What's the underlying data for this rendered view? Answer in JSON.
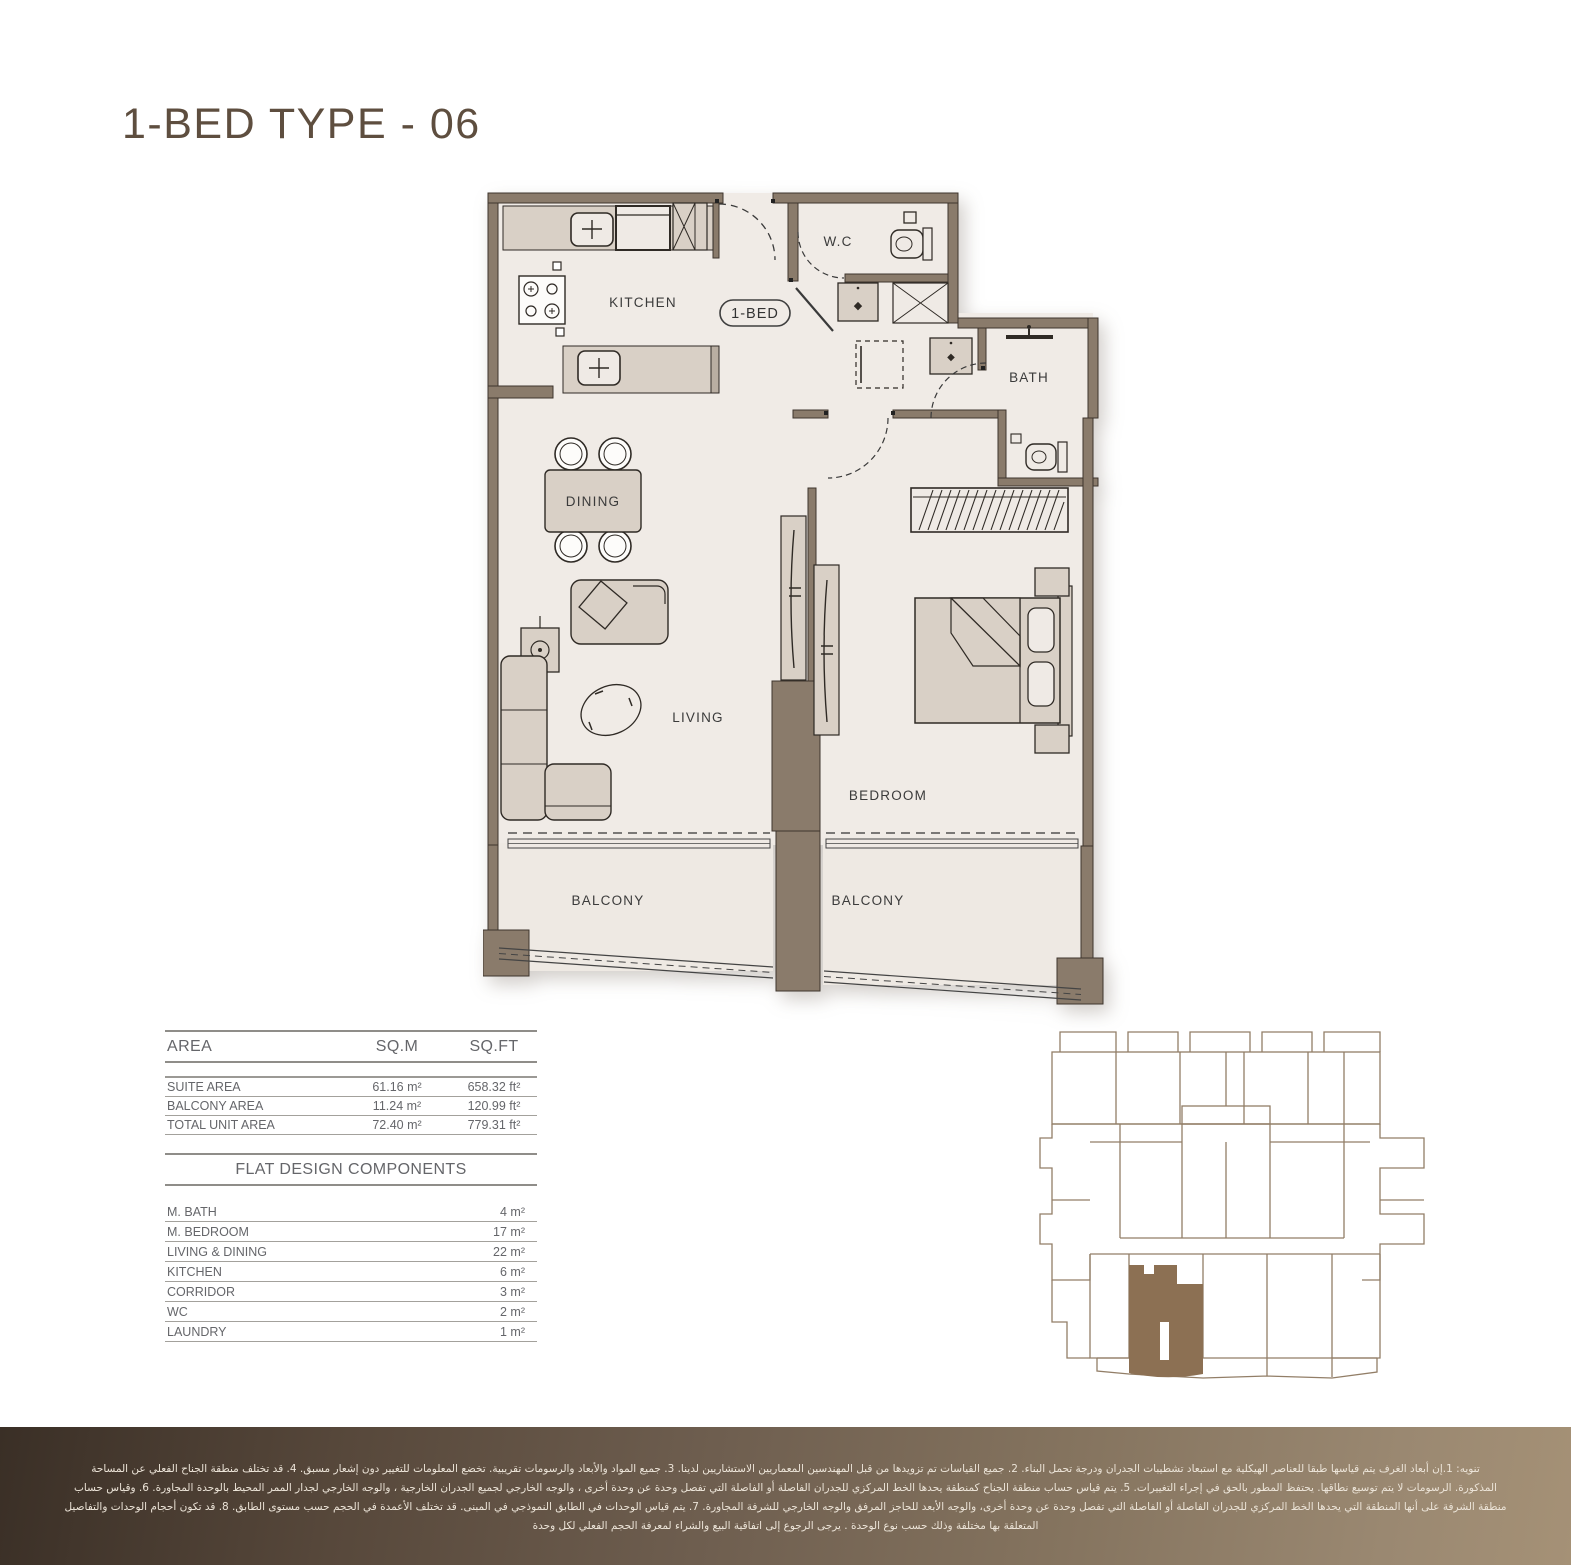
{
  "page": {
    "title": "1-BED TYPE - 06"
  },
  "plan": {
    "badge": "1-BED",
    "labels": {
      "kitchen": "KITCHEN",
      "wc": "W.C",
      "bath": "BATH",
      "dining": "DINING",
      "living": "LIVING",
      "bedroom": "BEDROOM",
      "balcony_left": "BALCONY",
      "balcony_right": "BALCONY"
    }
  },
  "area_table": {
    "headers": [
      "AREA",
      "SQ.M",
      "SQ.FT"
    ],
    "rows": [
      {
        "label": "SUITE AREA",
        "sqm": "61.16 m²",
        "sqft": "658.32 ft²"
      },
      {
        "label": "BALCONY AREA",
        "sqm": "11.24 m²",
        "sqft": "120.99 ft²"
      },
      {
        "label": "TOTAL UNIT AREA",
        "sqm": "72.40 m²",
        "sqft": "779.31 ft²"
      }
    ]
  },
  "components_table": {
    "title": "FLAT DESIGN COMPONENTS",
    "rows": [
      {
        "label": "M. BATH",
        "value": "4 m²"
      },
      {
        "label": "M. BEDROOM",
        "value": "17 m²"
      },
      {
        "label": "LIVING & DINING",
        "value": "22 m²"
      },
      {
        "label": "KITCHEN",
        "value": "6 m²"
      },
      {
        "label": "CORRIDOR",
        "value": "3 m²"
      },
      {
        "label": "WC",
        "value": "2 m²"
      },
      {
        "label": "LAUNDRY",
        "value": "1 m²"
      }
    ]
  },
  "footer": {
    "lines": [
      "تنويه: 1.إن أبعاد الغرف يتم قياسها طبقا للعناصر الهيكلية مع استبعاد تشطيبات الجدران ودرجة تحمل البناء. 2. جميع القياسات تم تزويدها من قبل المهندسين المعماريين الاستشاريين لدينا. 3. جميع المواد والأبعاد والرسومات تقريبية. تخضع المعلومات للتغيير دون إشعار مسبق. 4. قد تختلف منطقة الجناح الفعلي عن المساحة",
      "المذكورة. الرسومات لا يتم توسيع نطاقها. يحتفظ المطور بالحق في إجراء التغييرات. 5. يتم قياس حساب منطقة الجناح كمنطقة يحدها الخط المركزي للجدران الفاصلة أو الفاصلة التي تفصل وحدة عن وحدة أخرى ، والوجه الخارجي لجميع الجدران الخارجية ، والوجه الخارجي لجدار الممر المحيط بالوحدة المجاورة. 6. وقياس حساب",
      "منطقة الشرفة على أنها المنطقة التي يحدها الخط المركزي للجدران الفاصلة أو الفاصلة التي تفصل وحدة عن وحدة أخرى، والوجه الأبعد للحاجز المرفق والوجه الخارجي للشرفة المجاورة. 7. يتم قياس الوحدات في الطابق النموذجي في المبنى. قد تختلف الأعمدة في الحجم حسب مستوى الطابق. 8. قد تكون أحجام الوحدات والتفاصيل",
      "المتعلقة بها مختلفة وذلك حسب نوع الوحدة . يرجى الرجوع إلى اتفاقية البيع والشراء لمعرفة الحجم الفعلي لكل وحدة"
    ]
  },
  "colors": {
    "title": "#5e4e3f",
    "wall": "#8a7b6b",
    "wall_outline": "#3e352d",
    "floor": "#f0ebe6",
    "furniture": "#d9d0c6",
    "table_text": "#65666a",
    "keyplan_line": "#927e67",
    "keyplan_highlight": "#8c7053",
    "footer_dark": "#3a2f26",
    "footer_light": "#a59176"
  }
}
